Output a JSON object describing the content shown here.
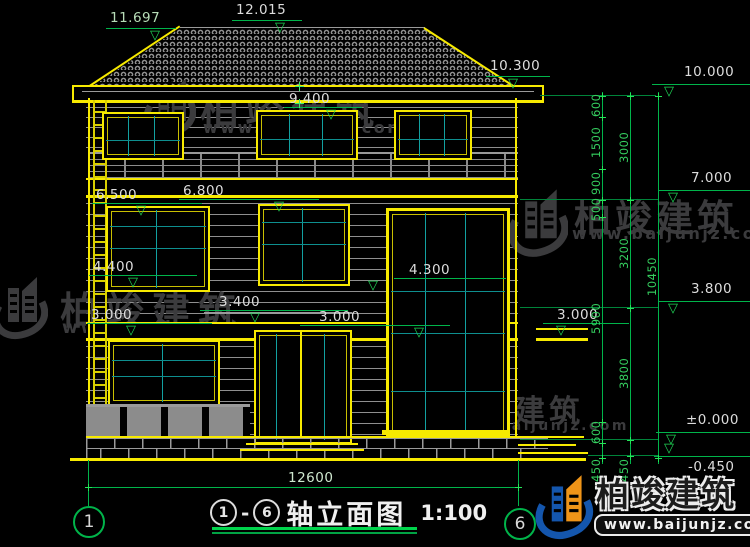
{
  "drawing": {
    "title": {
      "prefix_axis": "1",
      "separator": "-",
      "suffix_axis": "6",
      "name": "轴立面图",
      "scale": "1:100"
    },
    "axes": {
      "left": "1",
      "right": "6"
    },
    "elevation_labels": {
      "ridge_minor": "11.697",
      "ridge_main": "12.015",
      "eave_top": "10.300",
      "eave_soffit": "9.400",
      "balcony_upper": "6.500",
      "rail_upper": "6.800",
      "sill_2f": "4.400",
      "floor_2f_left": "3.000",
      "ledge_2f": "3.400",
      "floor_2f_mid": "3.000",
      "stair_window": "4.300",
      "canopy_right": "3.000",
      "right_eave": "10.000",
      "right_3f": "7.000",
      "right_2f": "3.800",
      "right_gf": "±0.000",
      "right_ground": "-0.450"
    },
    "dim_chains": {
      "right_outer": [
        "600",
        "1500",
        "900",
        "500",
        "5900",
        "600",
        "450"
      ],
      "right_mid": [
        "3000",
        "3200",
        "3800",
        "450"
      ],
      "right_total": "10450",
      "bottom_total": "12600"
    }
  },
  "watermark": {
    "brand": "柏竣建筑",
    "url": "www.baijunjz.com"
  },
  "logo": {
    "brand": "柏竣建筑",
    "url": "www.baijunjz.com"
  },
  "colors": {
    "yellow": "#f7ea00",
    "green": "#00c24a",
    "teal": "#12a0a0",
    "white": "#dcdcdc",
    "watermark_gray": "#3b3b3d",
    "logo_blue": "#1456ad",
    "logo_orange": "#ef9418"
  }
}
